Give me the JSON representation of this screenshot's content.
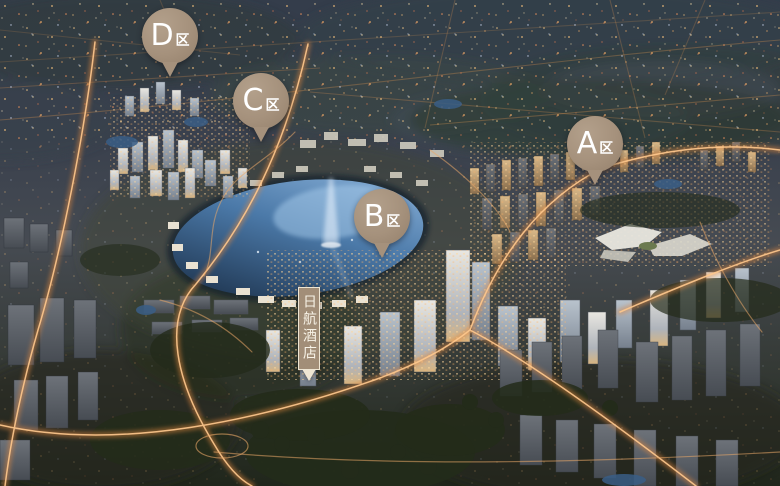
{
  "pins": [
    {
      "id": "D",
      "letter": "D",
      "suffix": "区"
    },
    {
      "id": "C",
      "letter": "C",
      "suffix": "区"
    },
    {
      "id": "B",
      "letter": "B",
      "suffix": "区"
    },
    {
      "id": "A",
      "letter": "A",
      "suffix": "区"
    }
  ],
  "hotel_label": {
    "text": "日航酒店"
  },
  "colors": {
    "pin": "#a5917c",
    "pin_text": "#ffffff",
    "label_bg": "#a28e78",
    "label_border": "#eee6d4",
    "label_text": "#f7f2e6",
    "road_glow": "#e08840",
    "road_core": "#ffc98e",
    "lake_light": "#8fb6dd",
    "lake_dark": "#16283f",
    "fountain": "#eef6ff"
  }
}
